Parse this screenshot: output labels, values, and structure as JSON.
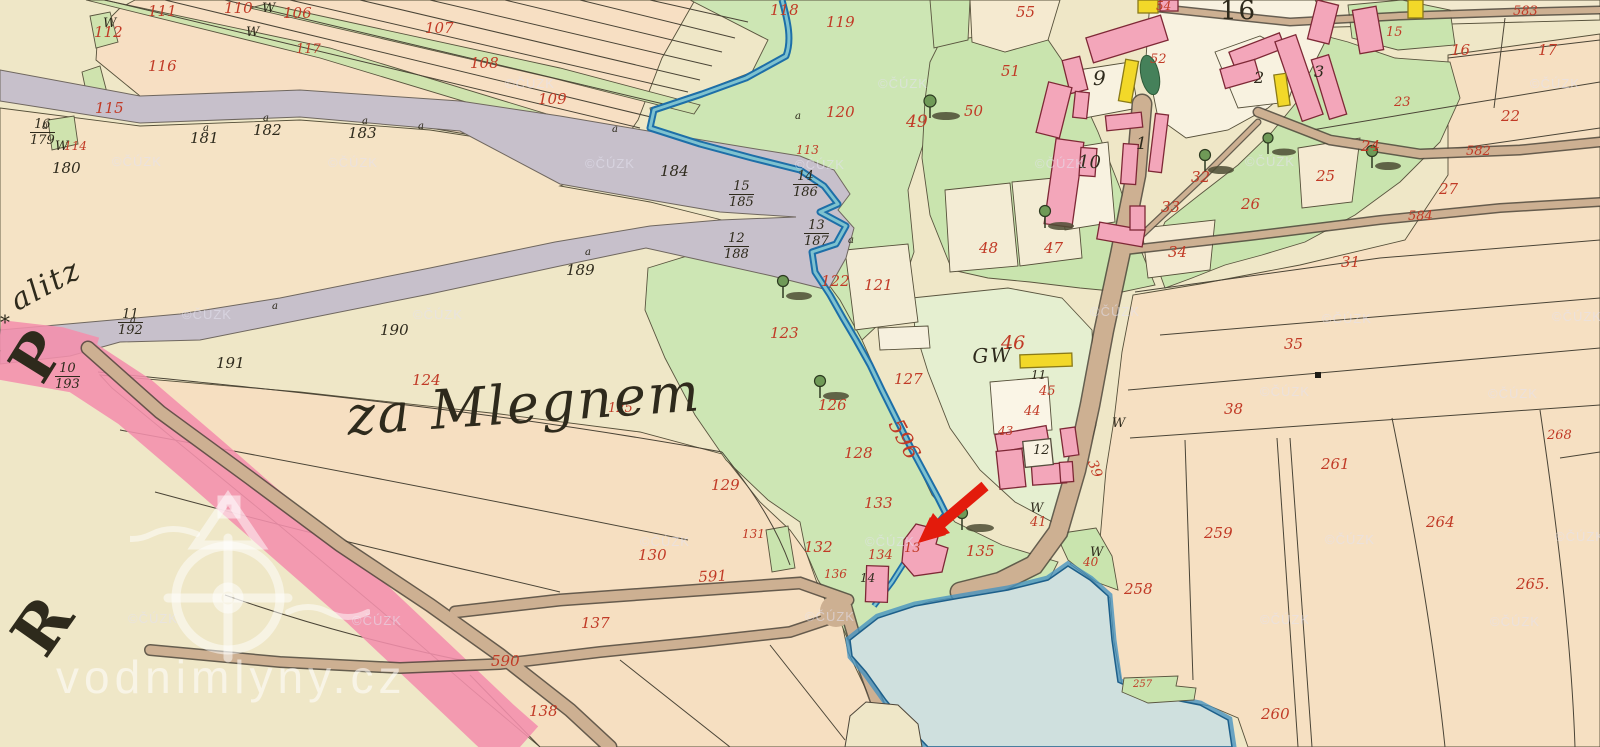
{
  "map": {
    "region_name": "za Mlegnem",
    "partial_place_name": "alitz",
    "star_mark": "*",
    "margin_letter_top": "P",
    "margin_letter_bottom": "R",
    "village_square_number": "16",
    "stream_number": "596",
    "watermark_site": "vodnimlyny.cz",
    "watermark_copyright": "©ČÚZK",
    "symbols": {
      "meadow_w": "W",
      "survey_a": "a"
    },
    "colors": {
      "parchment": "#efe7c7",
      "field_warm": "#f6dfc2",
      "meadow_green": "#c9e4ae",
      "pale_green": "#e5efd0",
      "road_gray": "#c7c0cb",
      "road_tan": "#cdb092",
      "boundary_ribbon_pink": "#f490ad",
      "building_pink": "#f3a6ba",
      "building_yellow": "#f2d829",
      "water_fill": "#cfe0de",
      "water_edge": "#4793c0",
      "ink_black": "#2e2a1c",
      "ink_red": "#c13a26",
      "arrow_red": "#e31b0c"
    },
    "labels_red": [
      [
        "111",
        148,
        4
      ],
      [
        "110",
        224,
        1
      ],
      [
        "106",
        283,
        6
      ],
      [
        "107",
        425,
        21
      ],
      [
        "108",
        470,
        56
      ],
      [
        "109",
        538,
        92
      ],
      [
        "112",
        94,
        25
      ],
      [
        "117",
        296,
        43,
        13
      ],
      [
        "116",
        148,
        59
      ],
      [
        "115",
        95,
        101
      ],
      [
        "114",
        64,
        140,
        12
      ],
      [
        "118",
        770,
        3
      ],
      [
        "119",
        826,
        15
      ],
      [
        "120",
        826,
        105
      ],
      [
        "122",
        821,
        274
      ],
      [
        "121",
        864,
        278
      ],
      [
        "123",
        770,
        326
      ],
      [
        "127",
        894,
        372
      ],
      [
        "126",
        818,
        398
      ],
      [
        "128",
        844,
        446
      ],
      [
        "129",
        711,
        478
      ],
      [
        "133",
        864,
        496
      ],
      [
        "132",
        804,
        540
      ],
      [
        "130",
        638,
        548
      ],
      [
        "134",
        868,
        549,
        13
      ],
      [
        "135",
        966,
        544
      ],
      [
        "136",
        824,
        568,
        12
      ],
      [
        "131",
        742,
        528,
        12
      ],
      [
        "137",
        581,
        616
      ],
      [
        "138",
        529,
        704
      ],
      [
        "591",
        698,
        570,
        15,
        -3
      ],
      [
        "590",
        491,
        654
      ],
      [
        "124",
        412,
        373
      ],
      [
        "125",
        608,
        402,
        13
      ],
      [
        "113",
        796,
        144,
        12
      ],
      [
        "596",
        903,
        416,
        22,
        62
      ],
      [
        "55",
        1016,
        5
      ],
      [
        "51",
        1001,
        64
      ],
      [
        "49",
        906,
        114,
        17
      ],
      [
        "50",
        964,
        104
      ],
      [
        "48",
        979,
        241
      ],
      [
        "47",
        1044,
        241
      ],
      [
        "54",
        1156,
        0,
        12
      ],
      [
        "52",
        1150,
        53,
        13
      ],
      [
        "15",
        1386,
        26,
        13
      ],
      [
        "16",
        1451,
        43
      ],
      [
        "17",
        1538,
        43
      ],
      [
        "23",
        1394,
        96,
        13
      ],
      [
        "22",
        1501,
        109
      ],
      [
        "24",
        1361,
        139
      ],
      [
        "25",
        1316,
        169
      ],
      [
        "26",
        1241,
        197
      ],
      [
        "27",
        1439,
        182
      ],
      [
        "31",
        1341,
        255
      ],
      [
        "32",
        1191,
        170
      ],
      [
        "33",
        1161,
        200
      ],
      [
        "34",
        1168,
        245
      ],
      [
        "583",
        1513,
        5,
        13
      ],
      [
        "582",
        1466,
        145,
        13
      ],
      [
        "584",
        1408,
        210,
        13
      ],
      [
        "46",
        1001,
        334,
        19
      ],
      [
        "45",
        1039,
        385,
        13
      ],
      [
        "44",
        1024,
        405,
        13
      ],
      [
        "43",
        998,
        425,
        12
      ],
      [
        "39",
        1098,
        458,
        14,
        70
      ],
      [
        "41",
        1030,
        516,
        13
      ],
      [
        "40",
        1083,
        556,
        12
      ],
      [
        "35",
        1284,
        337
      ],
      [
        "38",
        1224,
        402
      ],
      [
        "261",
        1321,
        457
      ],
      [
        "268",
        1547,
        429,
        13
      ],
      [
        "264",
        1426,
        515
      ],
      [
        "265.",
        1516,
        577
      ],
      [
        "259",
        1204,
        526
      ],
      [
        "258",
        1124,
        582
      ],
      [
        "260",
        1261,
        707
      ],
      [
        "257",
        1133,
        680,
        10
      ],
      [
        "13",
        904,
        542,
        13
      ]
    ],
    "labels_black": [
      [
        "180",
        52,
        161
      ],
      [
        "181",
        190,
        131
      ],
      [
        "182",
        253,
        123
      ],
      [
        "183",
        348,
        126
      ],
      [
        "184",
        660,
        164
      ],
      [
        "189",
        566,
        263
      ],
      [
        "190",
        380,
        323
      ],
      [
        "191",
        216,
        356
      ],
      [
        "9",
        1093,
        68,
        20
      ],
      [
        "10",
        1078,
        154,
        18
      ],
      [
        "1",
        1136,
        136,
        17
      ],
      [
        "2",
        1254,
        70,
        16
      ],
      [
        "3",
        1314,
        64,
        16
      ],
      [
        "11",
        1031,
        369,
        12
      ],
      [
        "12",
        1033,
        444,
        13
      ],
      [
        "14",
        860,
        572,
        12
      ]
    ],
    "fractions": [
      [
        "16",
        "179",
        30,
        118
      ],
      [
        "15",
        "185",
        729,
        180
      ],
      [
        "14",
        "186",
        793,
        170
      ],
      [
        "13",
        "187",
        804,
        219
      ],
      [
        "12",
        "188",
        724,
        232
      ],
      [
        "11",
        "192",
        118,
        308
      ],
      [
        "10",
        "193",
        55,
        362
      ]
    ],
    "display_texts": [
      {
        "t": "za Mlegnem",
        "x": 345,
        "y": 390,
        "s": 54,
        "r": -4,
        "c": "cursive",
        "n": "region-name-label"
      },
      {
        "t": "alitz",
        "x": 6,
        "y": 290,
        "s": 30,
        "r": -28,
        "c": "cursive",
        "n": "partial-place-name"
      },
      {
        "t": "*",
        "x": 0,
        "y": 312,
        "s": 20,
        "r": 0,
        "c": "",
        "n": "star-mark"
      },
      {
        "t": "P",
        "x": 0,
        "y": 360,
        "s": 60,
        "r": -58,
        "c": "letter",
        "n": "margin-letter-p"
      },
      {
        "t": "R",
        "x": 2,
        "y": 630,
        "s": 64,
        "r": -55,
        "c": "letter",
        "n": "margin-letter-r"
      },
      {
        "t": "GW",
        "x": 972,
        "y": 346,
        "s": 20,
        "r": -2,
        "c": "cursive",
        "n": "gw-label"
      },
      {
        "t": "16",
        "x": 1220,
        "y": -2,
        "s": 26,
        "r": 0,
        "c": "plaza",
        "n": "village-square-number"
      }
    ],
    "w_marks": [
      [
        262,
        2
      ],
      [
        246,
        26
      ],
      [
        103,
        17
      ],
      [
        55,
        140
      ],
      [
        1112,
        417
      ],
      [
        1030,
        502
      ],
      [
        1090,
        546
      ]
    ],
    "survey_marks": [
      [
        42,
        122
      ],
      [
        203,
        124
      ],
      [
        263,
        114
      ],
      [
        362,
        117
      ],
      [
        418,
        122
      ],
      [
        612,
        125
      ],
      [
        795,
        112
      ],
      [
        848,
        236
      ],
      [
        130,
        316
      ],
      [
        272,
        302
      ],
      [
        585,
        248
      ]
    ],
    "cuzk_positions": [
      [
        112,
        155
      ],
      [
        328,
        156
      ],
      [
        505,
        77
      ],
      [
        585,
        157
      ],
      [
        878,
        77
      ],
      [
        1035,
        157
      ],
      [
        1245,
        155
      ],
      [
        1530,
        77
      ],
      [
        182,
        308
      ],
      [
        413,
        308
      ],
      [
        128,
        612
      ],
      [
        352,
        614
      ],
      [
        865,
        535
      ],
      [
        1090,
        305
      ],
      [
        1322,
        312
      ],
      [
        1552,
        310
      ],
      [
        1260,
        385
      ],
      [
        1488,
        387
      ],
      [
        1325,
        533
      ],
      [
        1555,
        530
      ],
      [
        1260,
        613
      ],
      [
        1490,
        615
      ],
      [
        640,
        535
      ],
      [
        805,
        610
      ],
      [
        795,
        158
      ]
    ]
  }
}
